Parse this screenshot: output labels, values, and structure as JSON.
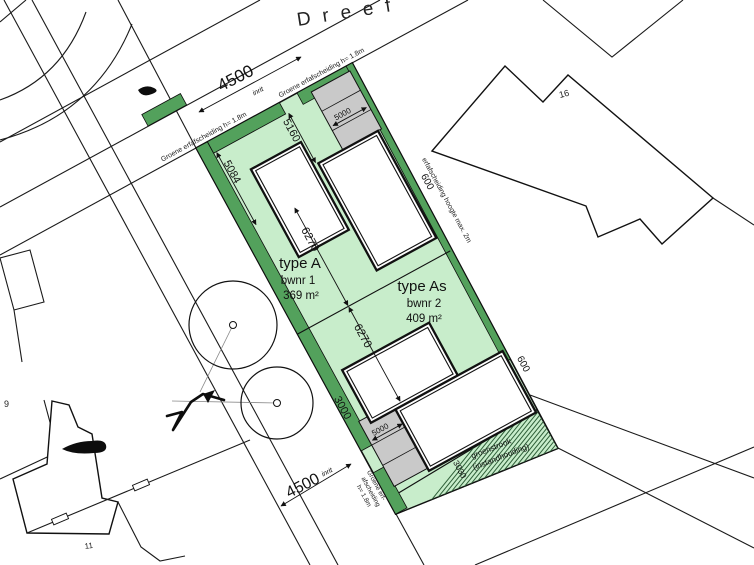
{
  "drawing": {
    "street_name": "Dreef",
    "parcels": {
      "type_a": {
        "title": "type A",
        "bwnr": "bwnr 1",
        "area": "369 m²"
      },
      "type_as": {
        "title": "type As",
        "bwnr": "bwnr 2",
        "area": "409 m²"
      }
    },
    "dimensions": {
      "inrit_top": "4500",
      "inrit_top_label": "inrit",
      "inrit_bottom": "4500",
      "inrit_bottom_label": "inrit",
      "dim_5160": "5160",
      "dim_5084": "5084",
      "dim_6270_a": "6270",
      "dim_6270_b": "6270",
      "dim_600_top": "600",
      "dim_600_bottom": "600",
      "dim_3000": "3000",
      "dim_3030": "3030",
      "parking_top": "5000",
      "parking_bottom": "5000"
    },
    "annotations": {
      "fence_top_left": "Groene erfafscheiding h= 1.8m",
      "fence_top_right": "Groene erfafscheiding h= 1.8m",
      "fence_right": "erfafscheiding hoogte max. 2m",
      "fence_bottom_1": "Groene erf-",
      "fence_bottom_2": "afscheiding",
      "fence_bottom_3": "h= 1.8m",
      "green_strip_1": "groenstrook",
      "green_strip_2": "(instandhouding)"
    },
    "neighbor_numbers": {
      "north": "16",
      "west": "9",
      "south": "11"
    },
    "colors": {
      "plot_fill": "#c8edcb",
      "hedge": "#53a15c",
      "parking": "#c9c9c9",
      "hatch": "#2e5e38"
    }
  }
}
